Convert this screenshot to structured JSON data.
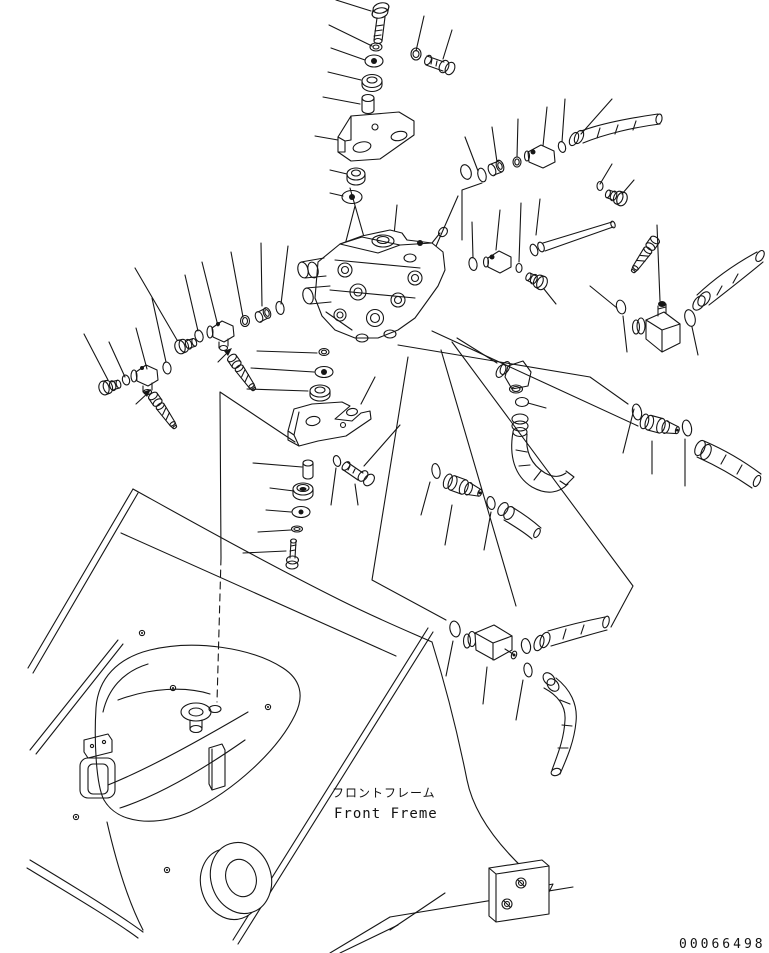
{
  "diagram": {
    "type": "exploded-parts-diagram",
    "frame_label_jp": "フロントフレーム",
    "frame_label_en": "Front Freme",
    "drawing_number": "00066498",
    "line_color": "#161616",
    "background_color": "#ffffff",
    "parts": [
      "hex-bolt",
      "spring-washer",
      "flat-washer",
      "rubber-cushion",
      "spacer",
      "upper-mounting-bracket",
      "hex-nut",
      "control-valve-assembly",
      "o-ring",
      "tee-fitting",
      "grease-nipple",
      "plug",
      "adapter-fitting",
      "elbow-fitting",
      "hose-coupling",
      "hydraulic-hose",
      "lower-mounting-bracket",
      "mounting-bolt",
      "front-frame",
      "frame-boss",
      "pivot-bore",
      "mounting-plate"
    ]
  }
}
